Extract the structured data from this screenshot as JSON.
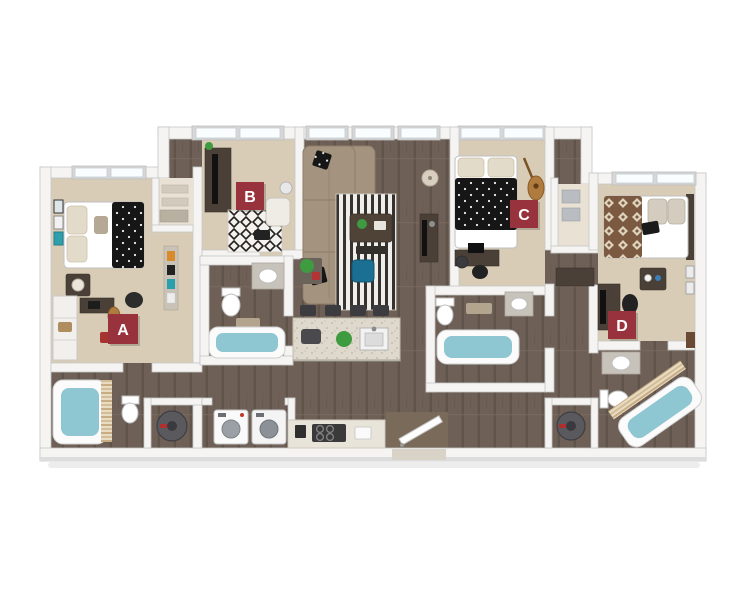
{
  "floorplan": {
    "description_label": "3D floor plan rendering, 4 bedroom 4 bathroom unit",
    "room_badges": [
      {
        "label": "A"
      },
      {
        "label": "B"
      },
      {
        "label": "C"
      },
      {
        "label": "D"
      }
    ],
    "badge_color": "#98333d",
    "badge_text_color": "#ffffff"
  },
  "colors": {
    "background": "#ffffff",
    "wall": "#f5f4f2",
    "wood_floor": "#6e6056",
    "carpet": "#d8ccb6",
    "closet_floor": "#e8e1d4",
    "tub_water": "#8ec6d2",
    "sofa": "#a3937f",
    "accent_chair": "#1b6f92",
    "island_counter": "#ded9cc",
    "dark_furniture": "#4a4038",
    "black_fabric": "#161616",
    "aztec_blanket": "#7b5a41",
    "plant_green": "#3f9b3f",
    "red_accent": "#a53430"
  }
}
